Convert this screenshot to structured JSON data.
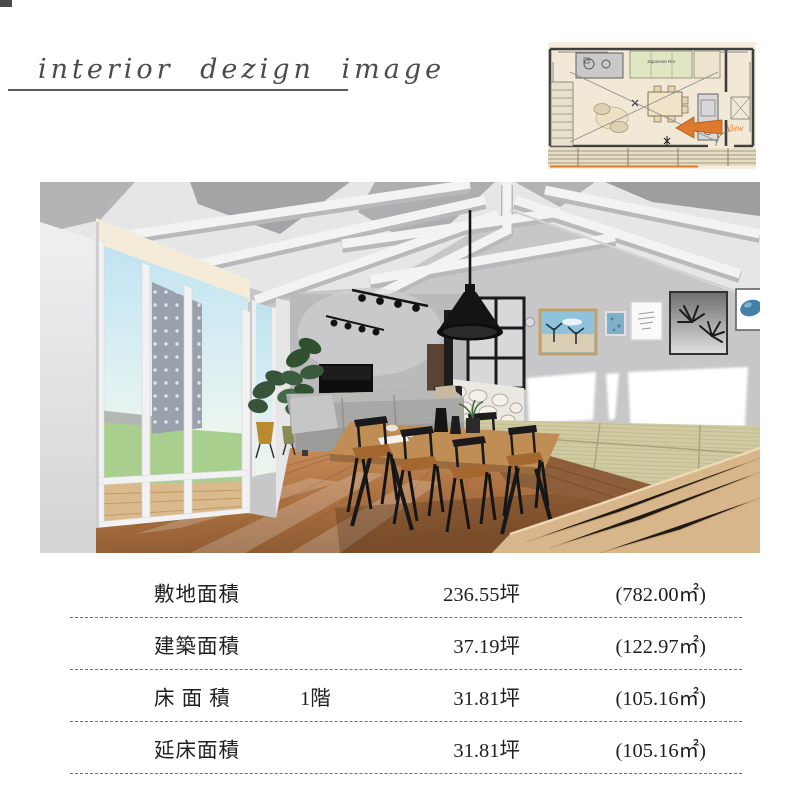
{
  "header": {
    "title": "interior dezign image"
  },
  "floor_plan": {
    "japanese_room_label": "Japanese Rm",
    "view_label": "View",
    "arrow_color": "#dd7a2e",
    "floor_color": "#f1e8d5",
    "tatami_room_color": "#dfe6c4"
  },
  "rendering": {
    "wall_color": "#c7c7c9",
    "ceiling_color": "#e6e6e7",
    "floor_color": "#c08a52",
    "tatami_color": "#d0caa2",
    "sofa_color": "#a8a8a6",
    "sky_color": "#bfe3f1",
    "lawn_color": "#a8cf8d",
    "accent_black": "#141414"
  },
  "area_table": {
    "rows": [
      {
        "label": "敷地面積",
        "floor": "",
        "tsubo": "236.55坪",
        "sqm": "(782.00㎡)"
      },
      {
        "label": "建築面積",
        "floor": "",
        "tsubo": "37.19坪",
        "sqm": "(122.97㎡)"
      },
      {
        "label": "床 面 積",
        "floor": "1階",
        "tsubo": "31.81坪",
        "sqm": "(105.16㎡)"
      },
      {
        "label": "延床面積",
        "floor": "",
        "tsubo": "31.81坪",
        "sqm": "(105.16㎡)"
      }
    ]
  }
}
